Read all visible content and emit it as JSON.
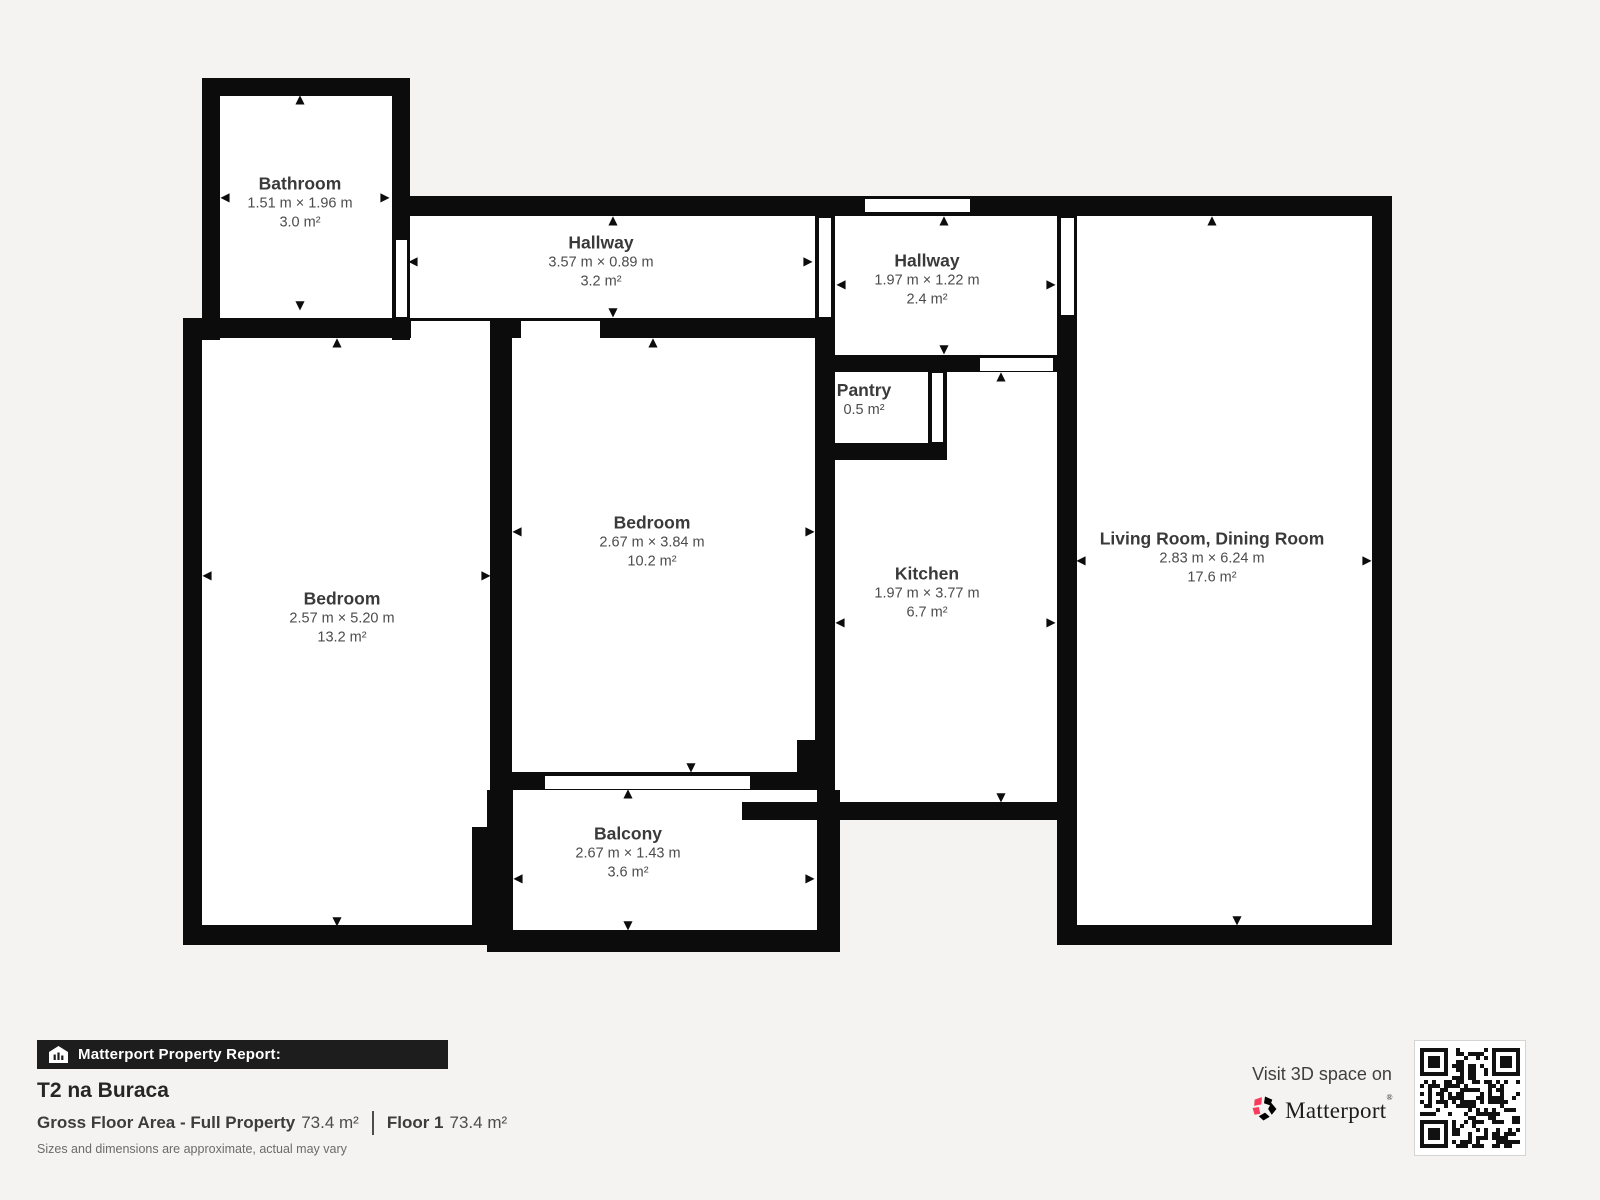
{
  "plan": {
    "rooms": [
      {
        "id": "bathroom",
        "name": "Bathroom",
        "dims": "1.51 m × 1.96 m",
        "area": "3.0 m²"
      },
      {
        "id": "hallway-top",
        "name": "Hallway",
        "dims": "3.57 m × 0.89 m",
        "area": "3.2 m²"
      },
      {
        "id": "hallway-entry",
        "name": "Hallway",
        "dims": "1.97 m × 1.22 m",
        "area": "2.4 m²"
      },
      {
        "id": "pantry",
        "name": "Pantry",
        "dims": "",
        "area": "0.5 m²"
      },
      {
        "id": "bedroom-left",
        "name": "Bedroom",
        "dims": "2.57 m × 5.20 m",
        "area": "13.2 m²"
      },
      {
        "id": "bedroom-center",
        "name": "Bedroom",
        "dims": "2.67 m × 3.84 m",
        "area": "10.2 m²"
      },
      {
        "id": "kitchen",
        "name": "Kitchen",
        "dims": "1.97 m × 3.77 m",
        "area": "6.7 m²"
      },
      {
        "id": "living-room",
        "name": "Living Room, Dining Room",
        "dims": "2.83 m × 6.24 m",
        "area": "17.6 m²"
      },
      {
        "id": "balcony",
        "name": "Balcony",
        "dims": "2.67 m × 1.43 m",
        "area": "3.6 m²"
      }
    ]
  },
  "icons": {
    "up": "▲",
    "down": "▼",
    "left": "◀",
    "right": "▶"
  },
  "footer": {
    "report_label": "Matterport Property Report:",
    "property_name": "T2 na Buraca",
    "gross_area_label": "Gross Floor Area - Full Property",
    "gross_area_value": "73.4 m²",
    "floor_label": "Floor 1",
    "floor_value": "73.4 m²",
    "disclaimer": "Sizes and dimensions are approximate, actual may vary"
  },
  "branding": {
    "visit_text": "Visit 3D space on",
    "wordmark": "Matterport",
    "trademark": "®",
    "brand_red": "#f73b5c",
    "wall_color": "#0c0c0c",
    "background": "#f4f3f1"
  }
}
